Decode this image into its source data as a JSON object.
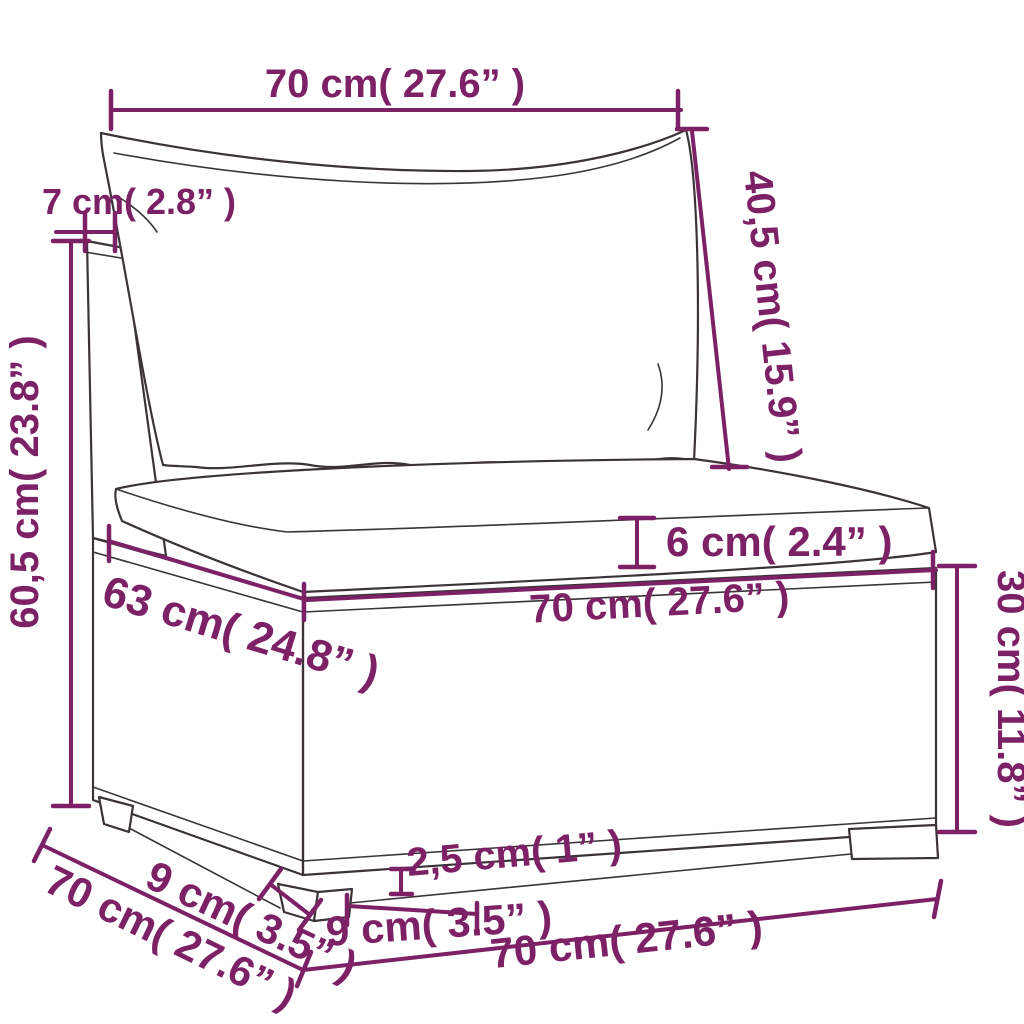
{
  "diagram": {
    "kind": "furniture-dimension-drawing",
    "subject": "rattan-sofa-section-with-cushions"
  },
  "colors": {
    "accent": "#7D2166",
    "line": "#3a3439",
    "background": "#ffffff"
  },
  "dims": {
    "top_width": "70 cm( 27.6” )",
    "backrest_thickness": "7 cm( 2.8” )",
    "backrest_height": "40,5 cm( 15.9” )",
    "overall_height": "60,5 cm( 23.8” )",
    "cushion_thickness": "6 cm( 2.4” )",
    "seat_depth": "63 cm( 24.8” )",
    "seat_width": "70 cm( 27.6” )",
    "base_height": "30 cm( 11.8” )",
    "base_depth": "70 cm( 27.6” )",
    "leg_inset_side": "9 cm( 3.5” )",
    "leg_height": "2,5 cm( 1” )",
    "leg_inset_front": "9 cm( 3.5” )",
    "base_width": "70 cm( 27.6” )"
  }
}
